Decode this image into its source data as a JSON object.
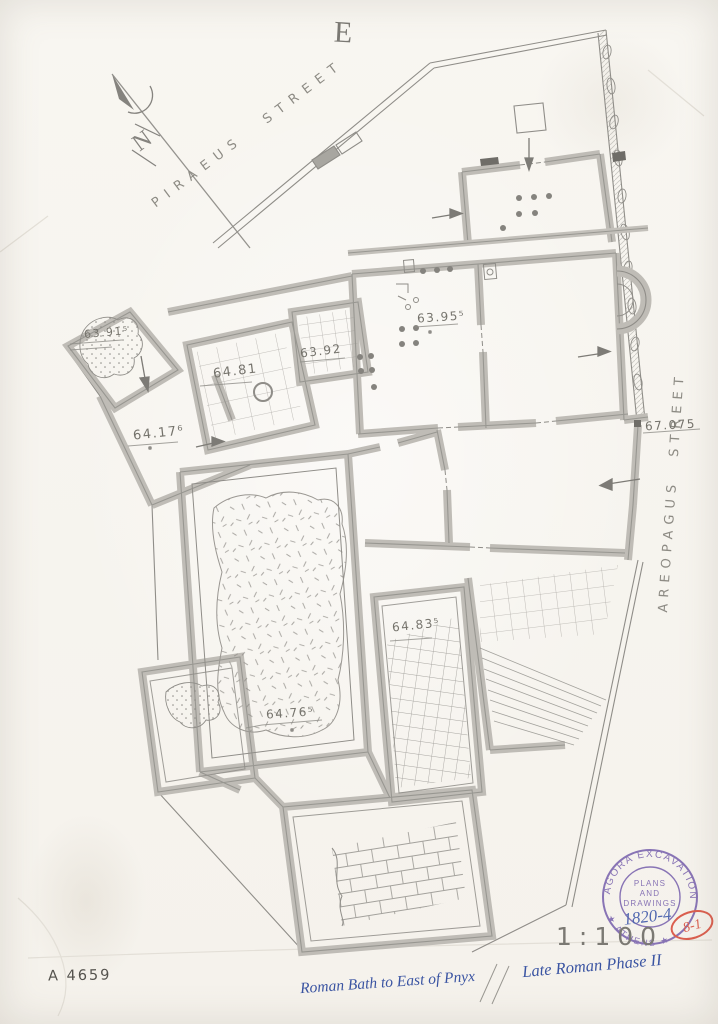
{
  "plan": {
    "compass_label": "N",
    "east_mark": "E",
    "streets": {
      "piraeus": "PIRAEUS STREET",
      "areopagus": "AREOPAGUS STREET"
    },
    "elevations": {
      "e6391": "63.91⁵",
      "e6481": "64.81",
      "e6392": "63.92",
      "e6417": "64.17⁶",
      "e6395": "63.95⁵",
      "e67075": "67.075",
      "e6483": "64.83⁵",
      "e6476": "64.76⁵"
    }
  },
  "stamp": {
    "arc_top": "AGORA EXCAVATIONS",
    "arc_bottom": "★ ATHENS ★",
    "line1": "PLANS",
    "line2": "AND",
    "line3": "DRAWINGS",
    "number": "1820-4",
    "red_mark": "8-1"
  },
  "footer": {
    "drawing_number": "A 4659",
    "scale": "1:100",
    "title": "Roman Bath to East of Pnyx",
    "phase": "Late Roman Phase II"
  }
}
